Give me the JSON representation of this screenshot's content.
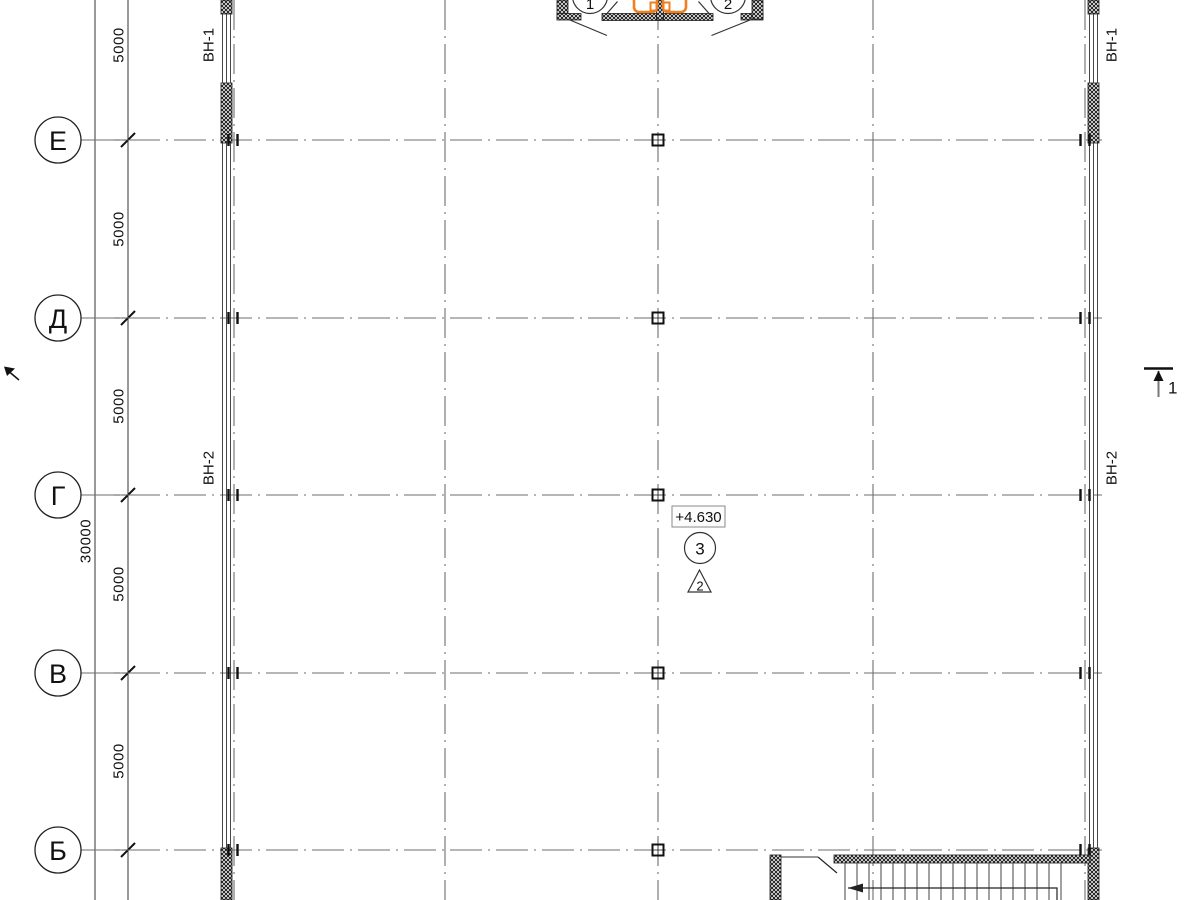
{
  "colors": {
    "accent_orange": "#ef7f1f",
    "line_dark": "#1a1a1a",
    "axis_gray": "#6e6e6e"
  },
  "plan": {
    "row_axes": [
      {
        "label": "Е"
      },
      {
        "label": "Д"
      },
      {
        "label": "Г"
      },
      {
        "label": "В"
      },
      {
        "label": "Б"
      }
    ],
    "dimensions": {
      "segments": [
        "5000",
        "5000",
        "5000",
        "5000",
        "5000"
      ],
      "overall": "30000"
    },
    "wall_tags": {
      "left_top": "ВН-1",
      "left_mid": "ВН-2",
      "right_top": "ВН-1",
      "right_mid": "ВН-2"
    },
    "annotations": {
      "elevation": "+4.630",
      "node_number": "3",
      "detail_number": "2",
      "section_number": "1"
    },
    "entrance": {
      "callout_left": "1",
      "callout_right": "2"
    }
  }
}
